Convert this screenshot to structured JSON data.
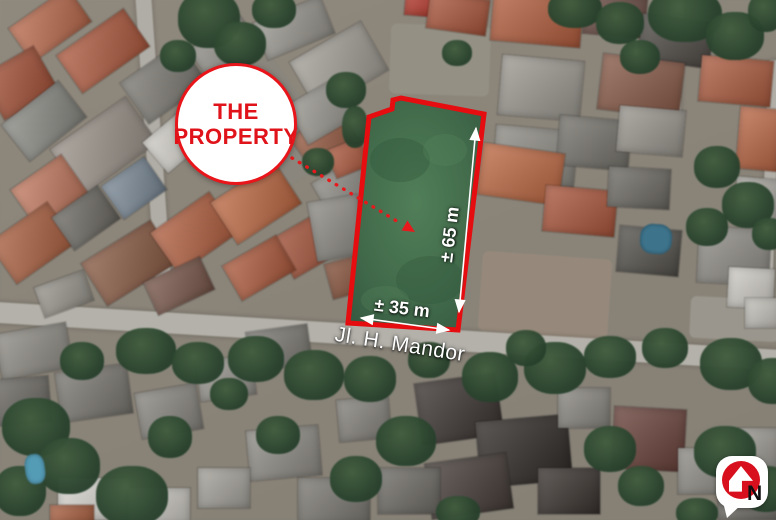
{
  "annotations": {
    "badge": {
      "line1": "THE",
      "line2": "PROPERTY"
    },
    "street_label": "Jl. H. Mandor",
    "dim_height": "± 65 m",
    "dim_width": "± 35 m",
    "north_label": "N"
  },
  "colors": {
    "accent_red": "#e8191c",
    "outline_red": "#e60d10",
    "property_green_center": "#517f58",
    "property_green_mid": "#426b4b",
    "property_green_edge": "#345740",
    "label_white": "#ffffff",
    "road_grey": "#b4b1a9"
  },
  "map": {
    "base": "#8f887c",
    "roads": [
      [
        -15,
        326,
        810,
        21,
        3.5,
        "#b4b1a9"
      ],
      [
        146,
        -8,
        16,
        315,
        -4,
        "#b0ada5"
      ],
      [
        668,
        -5,
        14,
        150,
        2,
        "#aeaba3"
      ],
      [
        764,
        60,
        12,
        250,
        2,
        "#b0ada5"
      ]
    ],
    "grounds": [
      [
        480,
        255,
        130,
        80,
        4,
        "#97897a"
      ],
      [
        390,
        25,
        100,
        70,
        2,
        "#949083"
      ],
      [
        690,
        298,
        90,
        42,
        3,
        "#9a968c"
      ],
      [
        250,
        60,
        60,
        120,
        -35,
        "#8a867c"
      ]
    ],
    "roofs": [
      [
        14,
        4,
        72,
        42,
        -35,
        "#c06a4a"
      ],
      [
        62,
        28,
        82,
        46,
        -35,
        "#b55a3c"
      ],
      [
        -12,
        58,
        62,
        50,
        -30,
        "#a85034"
      ],
      [
        8,
        98,
        72,
        46,
        -38,
        "#8a8a84"
      ],
      [
        58,
        118,
        92,
        56,
        -35,
        "#9b9288"
      ],
      [
        128,
        58,
        72,
        50,
        -35,
        "#7d7a72"
      ],
      [
        196,
        28,
        62,
        46,
        -35,
        "#8f8c84"
      ],
      [
        258,
        8,
        72,
        40,
        -22,
        "#99968e"
      ],
      [
        298,
        38,
        82,
        56,
        -30,
        "#a39f96"
      ],
      [
        18,
        168,
        62,
        46,
        -35,
        "#c97a5e"
      ],
      [
        -4,
        218,
        72,
        50,
        -35,
        "#b2613f"
      ],
      [
        58,
        198,
        56,
        40,
        -35,
        "#6e6b64"
      ],
      [
        108,
        168,
        52,
        40,
        -35,
        "#7a8a99"
      ],
      [
        148,
        118,
        62,
        40,
        -40,
        "#d0cdc6"
      ],
      [
        88,
        238,
        82,
        50,
        -32,
        "#8d5a42"
      ],
      [
        158,
        208,
        72,
        50,
        -35,
        "#b75f3e"
      ],
      [
        218,
        178,
        76,
        50,
        -33,
        "#c4683f"
      ],
      [
        278,
        218,
        72,
        46,
        -30,
        "#a54e32"
      ],
      [
        318,
        168,
        52,
        40,
        -30,
        "#8f8c85"
      ],
      [
        228,
        248,
        62,
        40,
        -30,
        "#b35a3a"
      ],
      [
        148,
        268,
        62,
        36,
        -25,
        "#7c584a"
      ],
      [
        38,
        278,
        52,
        32,
        -20,
        "#9a968d"
      ],
      [
        298,
        118,
        56,
        46,
        -35,
        "#9a5a40"
      ],
      [
        328,
        258,
        46,
        36,
        -15,
        "#8a5038"
      ],
      [
        330,
        143,
        36,
        30,
        -22,
        "#b55a3c"
      ],
      [
        293,
        88,
        60,
        45,
        -30,
        "#9a978f"
      ],
      [
        312,
        198,
        50,
        60,
        -10,
        "#8e8b84"
      ],
      [
        405,
        -6,
        32,
        22,
        5,
        "#c0392b"
      ],
      [
        428,
        -4,
        60,
        36,
        8,
        "#b05538"
      ],
      [
        492,
        -6,
        90,
        50,
        5,
        "#b85c3a"
      ],
      [
        584,
        -4,
        62,
        40,
        5,
        "#6b4a40"
      ],
      [
        640,
        18,
        72,
        46,
        8,
        "#4f4a45"
      ],
      [
        700,
        58,
        72,
        46,
        5,
        "#b25b3c"
      ],
      [
        738,
        108,
        42,
        62,
        5,
        "#c16743"
      ],
      [
        600,
        58,
        82,
        56,
        7,
        "#8a5844"
      ],
      [
        500,
        58,
        82,
        60,
        5,
        "#9c9890"
      ],
      [
        494,
        128,
        82,
        56,
        5,
        "#8e8b83"
      ],
      [
        558,
        118,
        72,
        50,
        5,
        "#75726a"
      ],
      [
        618,
        108,
        66,
        46,
        5,
        "#9a968e"
      ],
      [
        480,
        148,
        82,
        52,
        8,
        "#c4683f"
      ],
      [
        544,
        188,
        72,
        46,
        5,
        "#b05538"
      ],
      [
        608,
        168,
        62,
        40,
        3,
        "#6e6b64"
      ],
      [
        698,
        228,
        72,
        56,
        3,
        "#8f8c85"
      ],
      [
        728,
        268,
        46,
        40,
        3,
        "#d0cdc6"
      ],
      [
        618,
        228,
        62,
        46,
        5,
        "#55524c"
      ],
      [
        735,
        178,
        46,
        46,
        5,
        "#a9a69e"
      ],
      [
        745,
        298,
        36,
        30,
        0,
        "#c5c2ba"
      ],
      [
        -2,
        328,
        72,
        46,
        -10,
        "#8f8c84"
      ],
      [
        58,
        368,
        72,
        50,
        -8,
        "#7a7770"
      ],
      [
        -6,
        378,
        56,
        46,
        -5,
        "#6b6862"
      ],
      [
        138,
        388,
        62,
        46,
        -10,
        "#8a8780"
      ],
      [
        198,
        358,
        56,
        40,
        -8,
        "#99968e"
      ],
      [
        58,
        478,
        72,
        42,
        0,
        "#d8d5cf"
      ],
      [
        128,
        488,
        62,
        36,
        0,
        "#c9c6bf"
      ],
      [
        248,
        428,
        72,
        50,
        -5,
        "#8f8c85"
      ],
      [
        298,
        478,
        72,
        46,
        0,
        "#7b7871"
      ],
      [
        198,
        468,
        52,
        40,
        0,
        "#a5a29a"
      ],
      [
        418,
        378,
        82,
        62,
        -8,
        "#3a3330"
      ],
      [
        478,
        418,
        92,
        66,
        -5,
        "#2f2a27"
      ],
      [
        428,
        458,
        82,
        56,
        -8,
        "#453c38"
      ],
      [
        538,
        468,
        62,
        46,
        0,
        "#3a332f"
      ],
      [
        613,
        408,
        72,
        62,
        3,
        "#6b4038"
      ],
      [
        678,
        448,
        62,
        46,
        0,
        "#8f8c85"
      ],
      [
        718,
        478,
        62,
        42,
        0,
        "#75726b"
      ],
      [
        738,
        428,
        42,
        42,
        0,
        "#9a978f"
      ],
      [
        338,
        398,
        52,
        42,
        -5,
        "#85827b"
      ],
      [
        378,
        468,
        62,
        46,
        0,
        "#6e6b65"
      ],
      [
        558,
        388,
        52,
        40,
        0,
        "#8a8780"
      ],
      [
        248,
        328,
        62,
        40,
        -8,
        "#7d7a73"
      ],
      [
        50,
        505,
        44,
        18,
        0,
        "#b2613f"
      ]
    ],
    "trees": [
      [
        178,
        -10,
        62,
        58
      ],
      [
        214,
        22,
        52,
        44
      ],
      [
        252,
        -8,
        44,
        36
      ],
      [
        160,
        40,
        36,
        32
      ],
      [
        548,
        -10,
        54,
        38
      ],
      [
        596,
        2,
        48,
        42
      ],
      [
        648,
        -12,
        74,
        54
      ],
      [
        706,
        12,
        58,
        48
      ],
      [
        748,
        -8,
        36,
        40
      ],
      [
        620,
        40,
        40,
        34
      ],
      [
        326,
        72,
        40,
        36
      ],
      [
        342,
        106,
        26,
        42
      ],
      [
        302,
        148,
        32,
        28
      ],
      [
        442,
        40,
        30,
        26
      ],
      [
        694,
        146,
        46,
        42
      ],
      [
        722,
        182,
        52,
        46
      ],
      [
        686,
        208,
        42,
        38
      ],
      [
        752,
        218,
        34,
        32
      ],
      [
        60,
        342,
        44,
        38
      ],
      [
        116,
        328,
        60,
        46
      ],
      [
        172,
        342,
        52,
        42
      ],
      [
        228,
        336,
        56,
        46
      ],
      [
        284,
        350,
        60,
        50
      ],
      [
        344,
        356,
        52,
        46
      ],
      [
        408,
        342,
        42,
        36
      ],
      [
        462,
        352,
        56,
        50
      ],
      [
        524,
        342,
        62,
        52
      ],
      [
        584,
        336,
        52,
        42
      ],
      [
        642,
        328,
        46,
        40
      ],
      [
        700,
        338,
        62,
        52
      ],
      [
        748,
        358,
        50,
        46
      ],
      [
        506,
        330,
        40,
        36
      ],
      [
        2,
        398,
        68,
        58
      ],
      [
        38,
        438,
        62,
        56
      ],
      [
        96,
        466,
        72,
        60
      ],
      [
        -6,
        466,
        52,
        50
      ],
      [
        148,
        416,
        44,
        42
      ],
      [
        256,
        416,
        44,
        38
      ],
      [
        210,
        378,
        38,
        32
      ],
      [
        330,
        456,
        52,
        46
      ],
      [
        376,
        416,
        60,
        50
      ],
      [
        436,
        496,
        44,
        32
      ],
      [
        584,
        426,
        52,
        46
      ],
      [
        618,
        466,
        46,
        40
      ],
      [
        694,
        426,
        62,
        52
      ],
      [
        740,
        466,
        52,
        46
      ],
      [
        676,
        498,
        42,
        30
      ]
    ],
    "pools": [
      [
        25,
        454,
        20,
        30,
        -8,
        "#4f9cb8"
      ],
      [
        640,
        224,
        32,
        30,
        4,
        "#39758f"
      ]
    ]
  }
}
